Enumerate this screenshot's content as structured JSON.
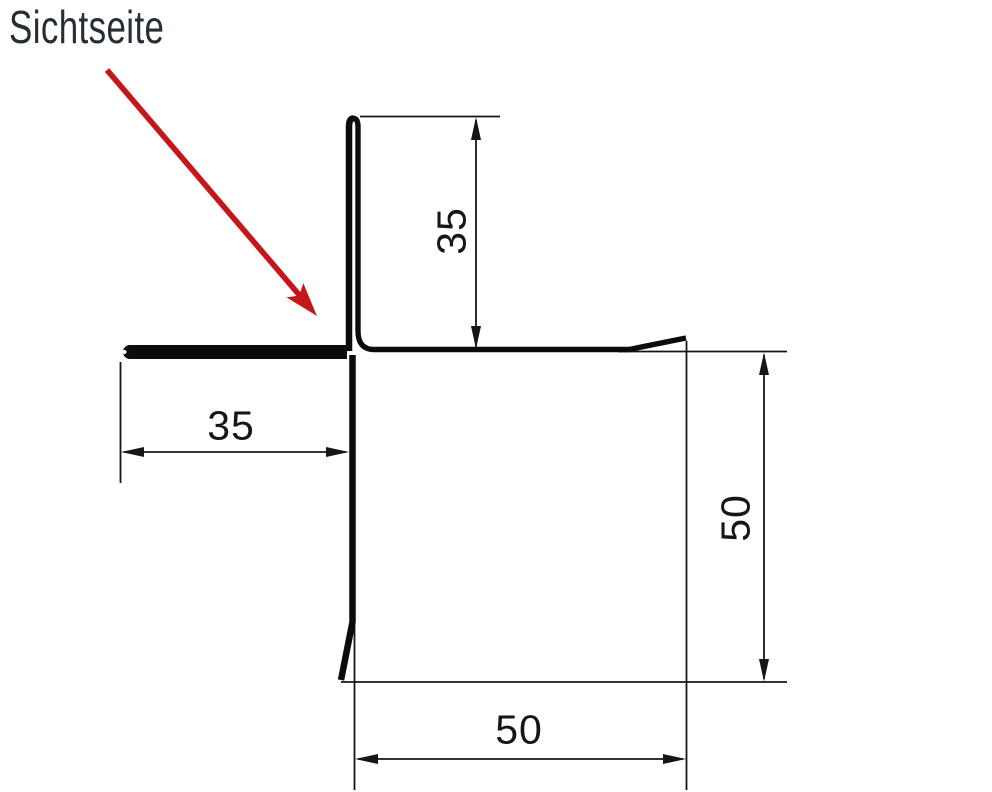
{
  "drawing": {
    "view_side_label": "Sichtseite",
    "dimensions": {
      "top_leg": "35",
      "left_leg": "35",
      "right_depth": "50",
      "bottom_width": "50"
    },
    "colors": {
      "line": "#0c0c0c",
      "dimension": "#161616",
      "arrow": "#c5161a",
      "label": "#272d36",
      "background": "#ffffff"
    }
  }
}
